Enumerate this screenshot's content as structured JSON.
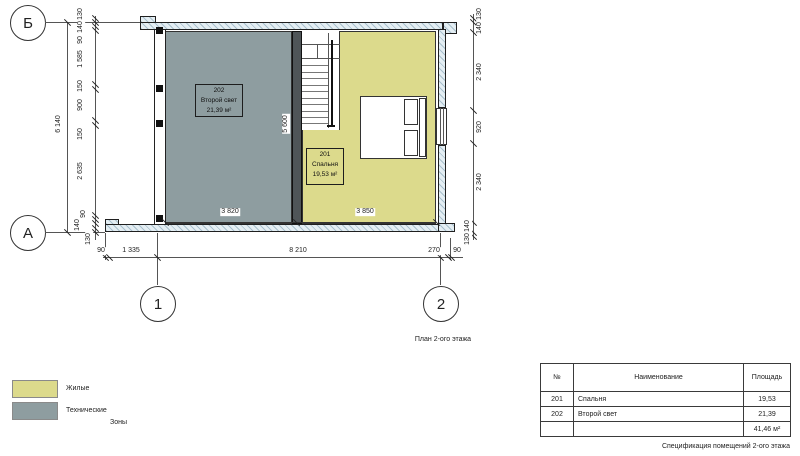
{
  "drawing": {
    "plan_caption": "План 2-ого этажа",
    "spec_caption": "Спецификация помещений 2-ого этажа"
  },
  "grid": {
    "rows": [
      "Б",
      "А"
    ],
    "cols": [
      "1",
      "2"
    ]
  },
  "rooms": [
    {
      "number": "202",
      "name": "Второй свет",
      "area": "21,39 м²"
    },
    {
      "number": "201",
      "name": "Спальня",
      "area": "19,53 м²"
    }
  ],
  "dimensions": {
    "left_overall": "6 140",
    "left_chain": [
      "130",
      "140",
      "90",
      "1 585",
      "150",
      "900",
      "150",
      "2 635",
      "90",
      "140",
      "130"
    ],
    "right_chain": [
      "130",
      "140",
      "2 340",
      "920",
      "2 340",
      "140",
      "130"
    ],
    "bottom_chain": [
      "90",
      "1 335",
      "8 210",
      "270",
      "90"
    ],
    "interior": {
      "room202_width": "3 820",
      "room201_width": "3 850",
      "stair_wall_height": "5 600"
    }
  },
  "legend": {
    "title": "Зоны",
    "items": [
      {
        "label": "Жилые",
        "color": "#dcda8c"
      },
      {
        "label": "Технические",
        "color": "#8e9da0"
      }
    ]
  },
  "table": {
    "headers": [
      "№",
      "Наименование",
      "Площадь"
    ],
    "rows": [
      [
        "201",
        "Спальня",
        "19,53"
      ],
      [
        "202",
        "Второй свет",
        "21,39"
      ]
    ],
    "total": "41,46 м²"
  },
  "colors": {
    "residential": "#dcda8c",
    "technical": "#8e9da0",
    "wall_fill": "#4f5558"
  }
}
